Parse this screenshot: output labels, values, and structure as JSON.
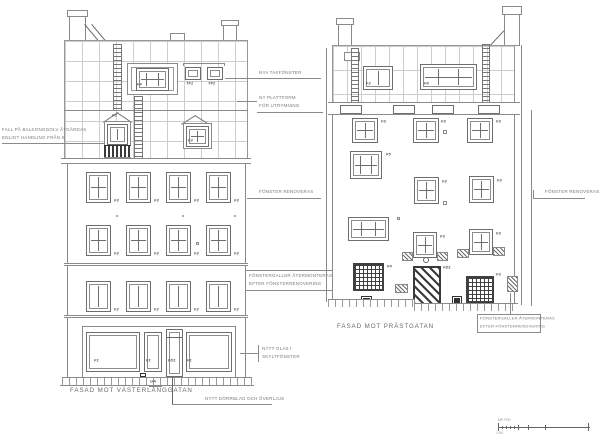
{
  "sheet": {
    "left_facade": {
      "title": "FASAD MOT VÄSTERLÅNGGATAN"
    },
    "right_facade": {
      "title": "FASAD MOT PRÄSTGATAN"
    }
  },
  "annotations": {
    "balcony_1": "FALL PÅ BALKONGGOLV ÅTGÄRDAS",
    "balcony_2": "ENLIGT HANDLING FRÅN K",
    "new_roof_windows": "NYA TAKFÖNSTER",
    "platform_1": "NY PLATTFORM",
    "platform_2": "FÖR UTRYMNING",
    "windows_renovated": "FÖNSTER RENOVERAS",
    "grilles_1": "FÖNSTERGALLER ÅTERMONTERAS",
    "grilles_2": "EFTER FÖNSTERRENOVERING",
    "shop_glass_1": "NYTT GLAS I",
    "shop_glass_2": "SKYLTFÖNSTER",
    "door": "NYTT DÖRRBLAD OCH ÖVERLJUS"
  },
  "labels": {
    "f1": "F1",
    "f2": "F2",
    "f3": "F3",
    "f4": "F4",
    "f5": "F5",
    "f6": "F6",
    "fd1": "FD1",
    "tf1": "TF1",
    "tf2": "TF2",
    "ga": "GA"
  },
  "scale_bar": {
    "unit": "METER",
    "ratio": "1:50"
  }
}
